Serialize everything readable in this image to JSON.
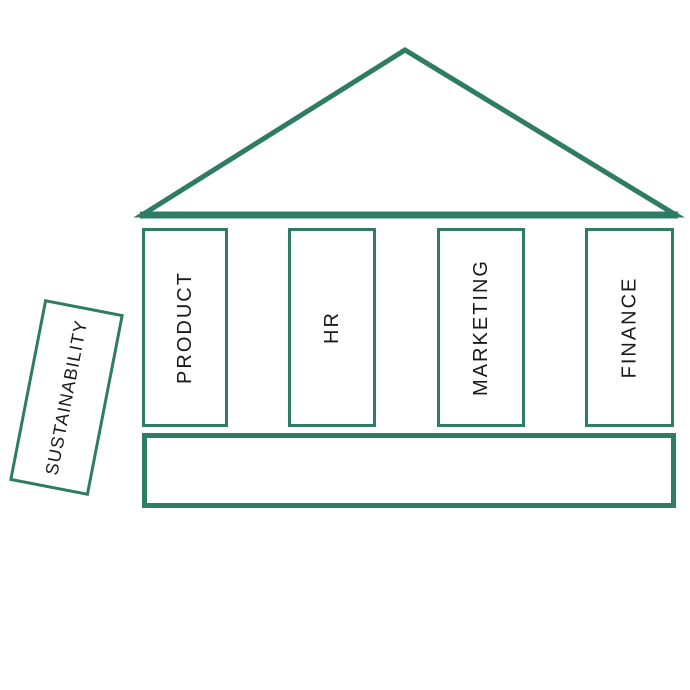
{
  "colors": {
    "outline": "#2D7C63",
    "label": "#1A1A1A",
    "background": "#FFFFFF"
  },
  "pillars": [
    {
      "label": "PRODUCT"
    },
    {
      "label": "HR"
    },
    {
      "label": "MARKETING"
    },
    {
      "label": "FINANCE"
    }
  ],
  "floating": {
    "label": "SUSTAINABILITY"
  },
  "foundation": {
    "label": ""
  }
}
